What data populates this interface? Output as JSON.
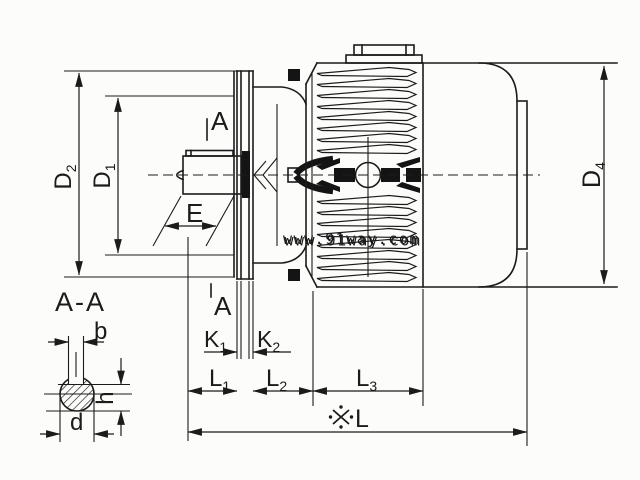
{
  "drawing": {
    "background": "#fcfcfb",
    "ink": "#1b1b1b",
    "section_view_label": "A-A",
    "section_marks": {
      "top": "A",
      "bottom": "A"
    },
    "dimensions": {
      "D2": {
        "main": "D",
        "sub": "2"
      },
      "D1": {
        "main": "D",
        "sub": "1"
      },
      "D4": {
        "main": "D",
        "sub": "4"
      },
      "E": {
        "main": "E",
        "sub": ""
      },
      "K1": {
        "main": "K",
        "sub": "1"
      },
      "K2": {
        "main": "K",
        "sub": "2"
      },
      "L1": {
        "main": "L",
        "sub": "1"
      },
      "L2": {
        "main": "L",
        "sub": "2"
      },
      "L3": {
        "main": "L",
        "sub": "3"
      },
      "L_total": {
        "symbol": "※",
        "main": "L",
        "sub": ""
      },
      "b": {
        "main": "b",
        "sub": ""
      },
      "h": {
        "main": "h",
        "sub": ""
      },
      "d": {
        "main": "d",
        "sub": ""
      }
    }
  },
  "watermark": {
    "text": "www.91way.com",
    "color": "#4a6bbf",
    "shadow_color": "#b9c6e8"
  }
}
